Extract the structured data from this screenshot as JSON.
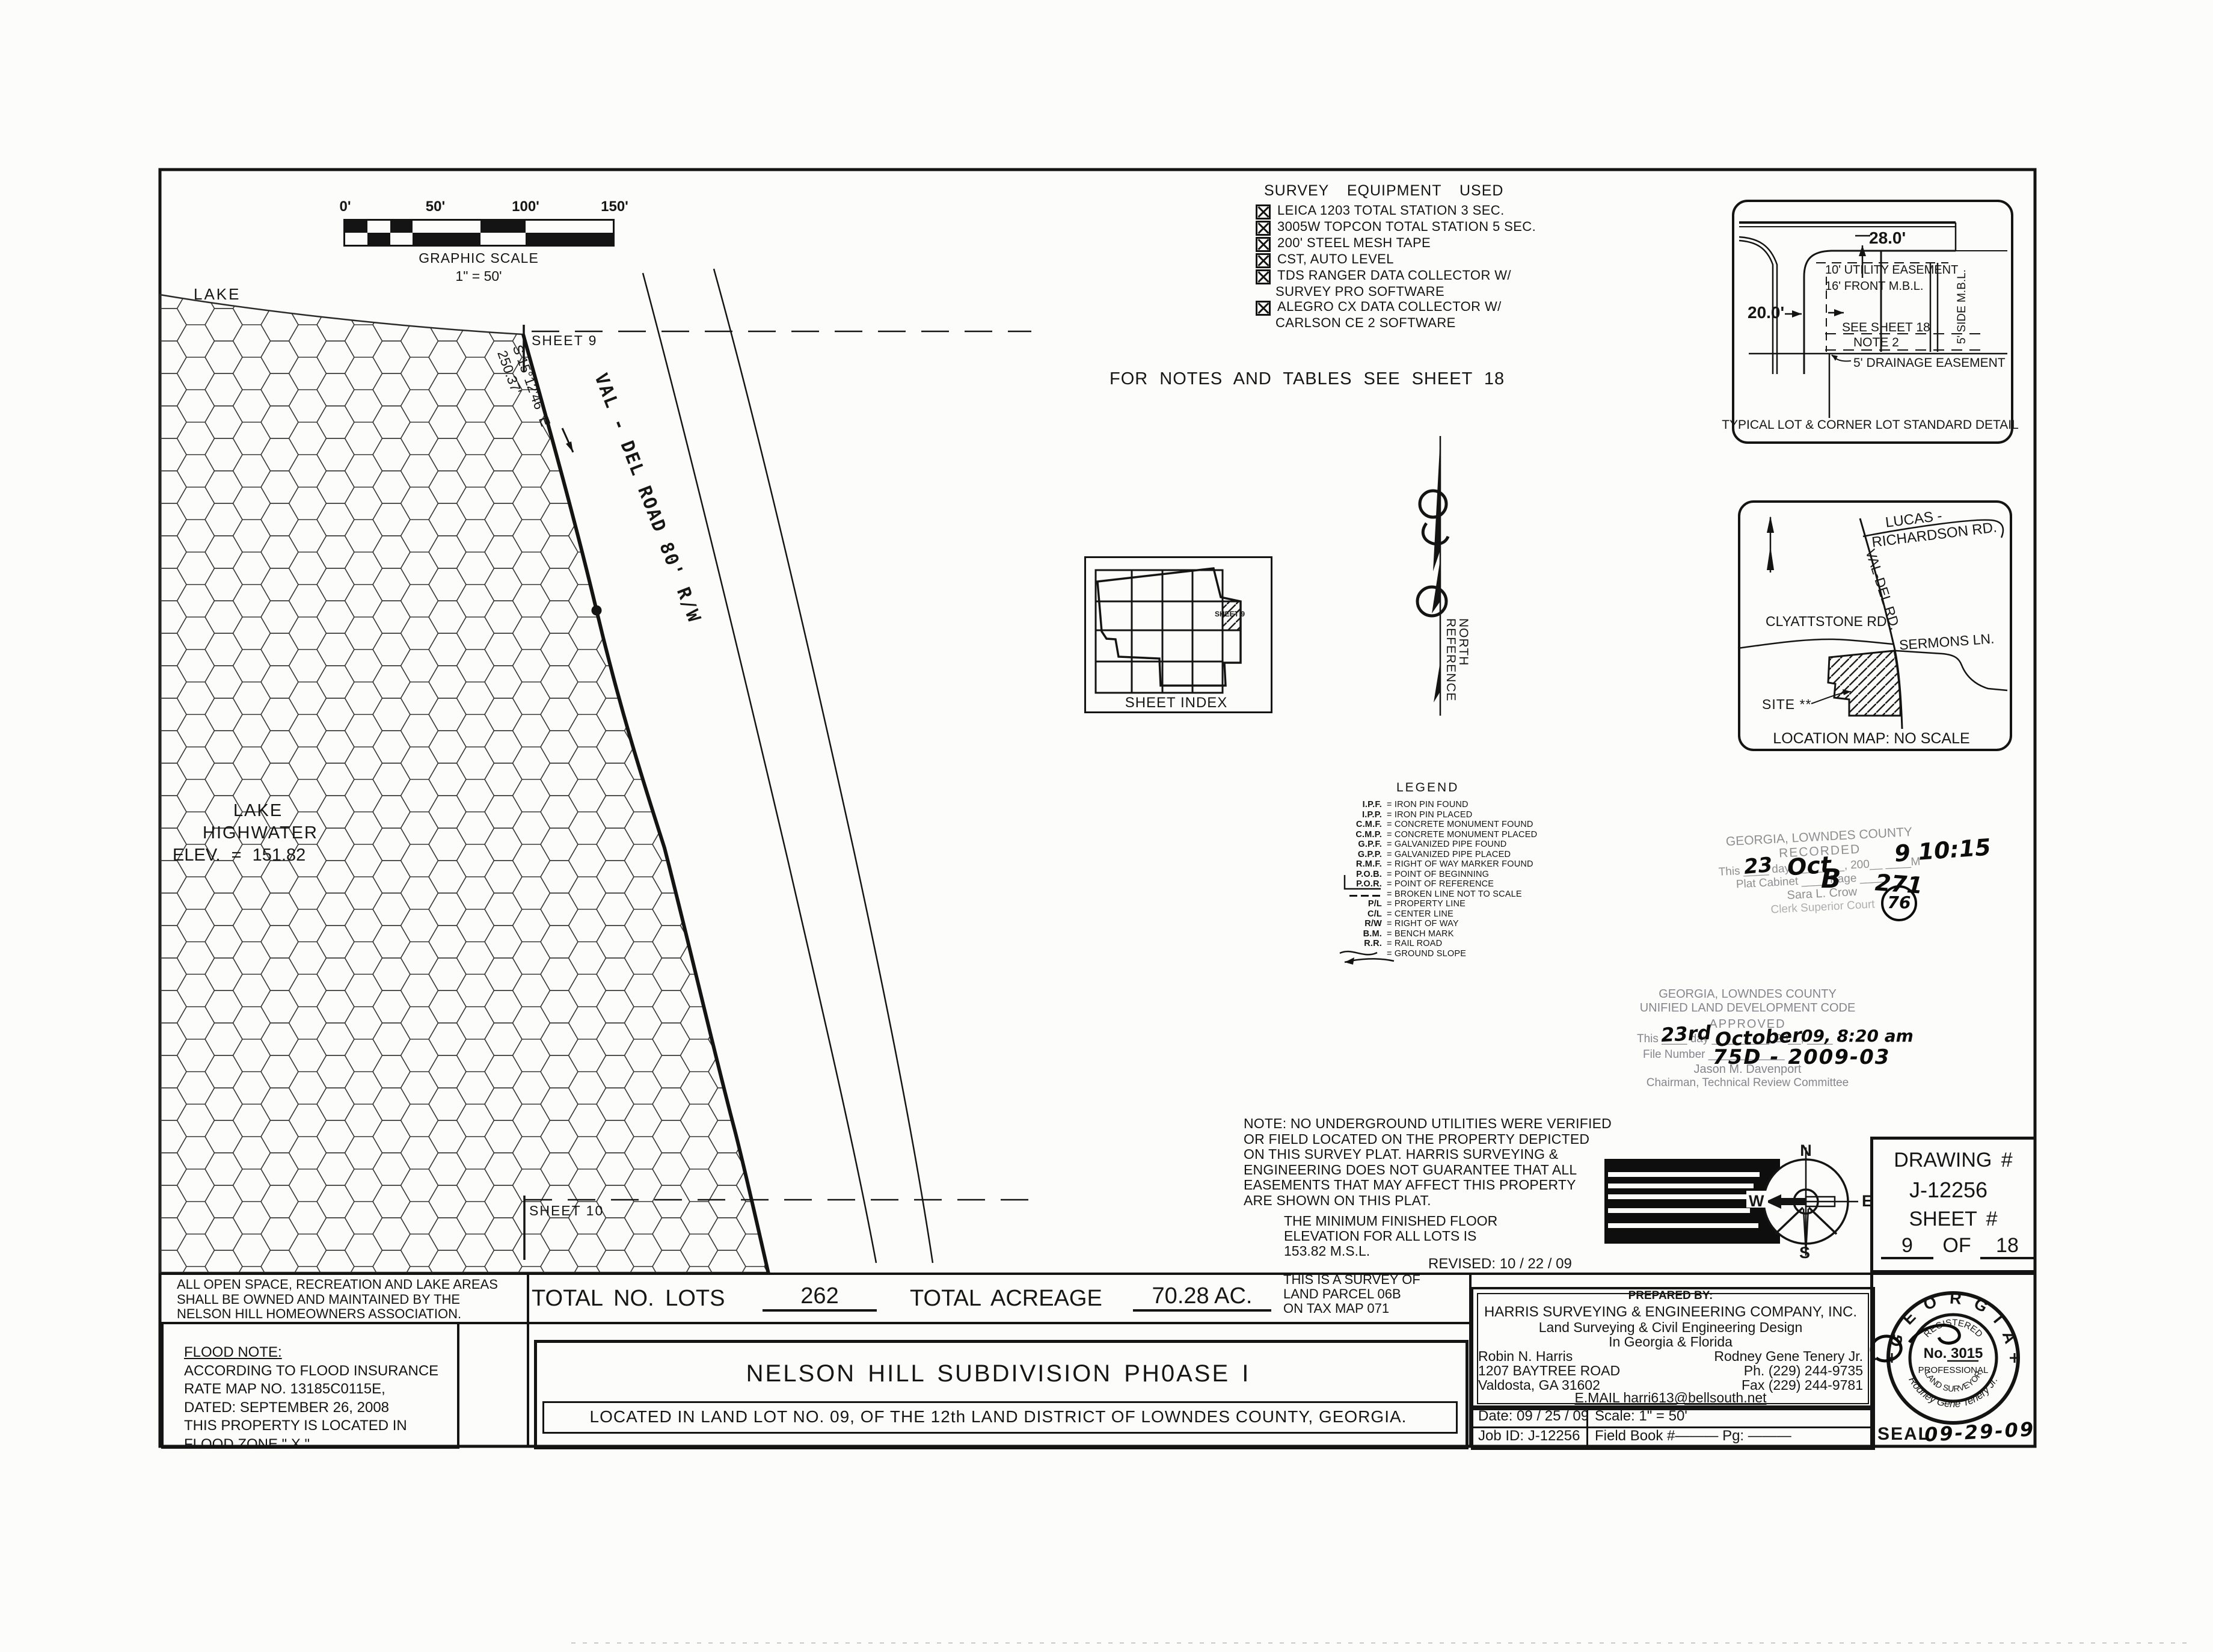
{
  "scalebar": {
    "t0": "0'",
    "t50": "50'",
    "t100": "100'",
    "t150": "150'",
    "caption": "GRAPHIC SCALE",
    "ratio": "1\" = 50'"
  },
  "lake": {
    "name": "LAKE",
    "hw1": "LAKE",
    "hw2": "HIGHWATER",
    "hw3": "ELEV. = 151.82"
  },
  "road": {
    "name": "VAL - DEL ROAD 80' R/W",
    "bearing": "S 15°12'46\" E",
    "distance": "250.37'"
  },
  "match": {
    "top": "SHEET 9",
    "bottom": "SHEET 10"
  },
  "equipment": {
    "title": "SURVEY EQUIPMENT USED",
    "rows": [
      {
        "text": "LEICA 1203 TOTAL STATION 3 SEC."
      },
      {
        "text": "3005W TOPCON TOTAL STATION 5 SEC."
      },
      {
        "text": "200' STEEL MESH TAPE"
      },
      {
        "text": "CST, AUTO LEVEL"
      },
      {
        "text": "TDS RANGER DATA COLLECTOR W/",
        "cont": "SURVEY PRO SOFTWARE"
      },
      {
        "text": "ALEGRO CX DATA COLLECTOR W/",
        "cont": "CARLSON CE 2 SOFTWARE"
      }
    ]
  },
  "banner": "FOR NOTES AND TABLES SEE SHEET 18",
  "sheet_index": {
    "caption": "SHEET INDEX",
    "cell": "SHEET 9"
  },
  "ref_north": {
    "l1": "REFERENCE",
    "l2": "NORTH"
  },
  "legend": {
    "title": "LEGEND",
    "items": [
      {
        "abbr": "I.P.F.",
        "text": "= IRON PIN FOUND"
      },
      {
        "abbr": "I.P.P.",
        "text": "= IRON PIN PLACED"
      },
      {
        "abbr": "C.M.F.",
        "text": "= CONCRETE MONUMENT FOUND"
      },
      {
        "abbr": "C.M.P.",
        "text": "= CONCRETE MONUMENT PLACED"
      },
      {
        "abbr": "G.P.F.",
        "text": "= GALVANIZED PIPE FOUND"
      },
      {
        "abbr": "G.P.P.",
        "text": "= GALVANIZED PIPE PLACED"
      },
      {
        "abbr": "R.M.F.",
        "text": "= RIGHT OF WAY MARKER FOUND"
      },
      {
        "abbr": "P.O.B.",
        "text": "= POINT OF BEGINNING"
      },
      {
        "abbr": "P.O.R.",
        "text": "= POINT OF REFERENCE"
      },
      {
        "abbr": "",
        "sym": "broken-line-icon",
        "text": "= BROKEN LINE NOT TO SCALE"
      },
      {
        "abbr": "P/L",
        "text": "= PROPERTY LINE"
      },
      {
        "abbr": "C/L",
        "text": "= CENTER LINE"
      },
      {
        "abbr": "R/W",
        "text": "= RIGHT OF WAY"
      },
      {
        "abbr": "B.M.",
        "text": "= BENCH MARK"
      },
      {
        "abbr": "R.R.",
        "text": "= RAIL ROAD"
      },
      {
        "abbr": "",
        "sym": "wave-line-icon",
        "text": "= GROUND SLOPE"
      }
    ]
  },
  "detail": {
    "d28": "28.0'",
    "d20": "20.0'",
    "utility": "10' UTILITY EASEMENT",
    "front": "16' FRONT M.B.L.",
    "see1": "SEE SHEET 18",
    "see2": "NOTE 2",
    "side": "5' SIDE M.B.L.",
    "drain": "5' DRAINAGE EASEMENT",
    "caption": "TYPICAL LOT & CORNER LOT STANDARD DETAIL"
  },
  "locmap": {
    "lucas1": "LUCAS -",
    "lucas2": "RICHARDSON RD.",
    "valdel": "VAL-DEL RD.",
    "clyatt": "CLYATTSTONE RD.",
    "sermons": "SERMONS LN.",
    "site": "SITE **",
    "caption": "LOCATION MAP: NO SCALE"
  },
  "recorded": {
    "l1": "GEORGIA, LOWNDES COUNTY",
    "l2": "RECORDED",
    "l3": "This ____ day ________, 200__ ____M",
    "l4": "Plat Cabinet ____ Page ____",
    "l5": "Sara L. Crow",
    "l6": "Clerk Superior Court",
    "hw_day": "23",
    "hw_month": "Oct",
    "hw_cabinet": "B",
    "hw_page": "271",
    "hw_yeartime": "9 10:15",
    "hw_monogram": "76"
  },
  "approved": {
    "l1": "GEORGIA, LOWNDES COUNTY",
    "l2": "UNIFIED LAND DEVELOPMENT CODE",
    "l3": "APPROVED",
    "l4": "This ____ day _________, 20__, ____",
    "l5": "File Number ____________",
    "l6": "Jason M. Davenport",
    "l7": "Chairman, Technical Review Committee",
    "hw_day": "23rd",
    "hw_month": "October",
    "hw_yeartime": "09, 8:20 am",
    "hw_file": "75D - 2009-03"
  },
  "notes": {
    "utility": [
      "NOTE: NO UNDERGROUND UTILITIES WERE VERIFIED",
      "OR FIELD LOCATED ON THE PROPERTY DEPICTED",
      "ON THIS SURVEY PLAT. HARRIS SURVEYING &",
      "ENGINEERING DOES NOT GUARANTEE THAT ALL",
      "EASEMENTS THAT MAY AFFECT THIS PROPERTY",
      "ARE SHOWN ON THIS PLAT."
    ],
    "floor": [
      "THE MINIMUM FINISHED FLOOR",
      "ELEVATION FOR ALL LOTS IS",
      "153.82 M.S.L."
    ],
    "revised": "REVISED: 10 / 22 / 09",
    "survey_of": [
      "THIS IS A SURVEY OF",
      "LAND PARCEL 06B",
      "ON TAX MAP 071"
    ],
    "open_space": [
      "ALL OPEN SPACE, RECREATION AND LAKE AREAS",
      "SHALL BE OWNED AND MAINTAINED BY THE",
      "NELSON HILL HOMEOWNERS ASSOCIATION."
    ],
    "flood": [
      "FLOOD NOTE:",
      "ACCORDING TO FLOOD INSURANCE",
      "RATE MAP NO. 13185C0115E,",
      "DATED: SEPTEMBER 26, 2008",
      "THIS PROPERTY IS LOCATED IN",
      "FLOOD ZONE \" X \"."
    ]
  },
  "totals": {
    "lots_label": "TOTAL NO. LOTS",
    "lots": "262",
    "acre_label": "TOTAL ACREAGE",
    "acre": "70.28 AC."
  },
  "titleblock": {
    "title": "NELSON HILL SUBDIVISION PH0ASE I",
    "subtitle": "LOCATED IN LAND LOT NO. 09, OF THE 12th LAND DISTRICT OF LOWNDES COUNTY, GEORGIA."
  },
  "prepared": {
    "label": "PREPARED BY:",
    "company": "HARRIS SURVEYING & ENGINEERING COMPANY, INC.",
    "l2": "Land Surveying & Civil Engineering Design",
    "l3": "In Georgia & Florida",
    "left1": "Robin N. Harris",
    "left2": "1207 BAYTREE ROAD",
    "left3": "Valdosta, GA 31602",
    "right1": "Rodney Gene Tenery Jr.",
    "right2": "Ph. (229) 244-9735",
    "right3": "Fax (229) 244-9781",
    "email": "E.MAIL  harri613@bellsouth.net"
  },
  "meta": {
    "date": "Date: 09 / 25 / 09",
    "scale": "Scale:  1\" = 50'",
    "job": "Job ID:  J-12256",
    "field": "Field Book #———   Pg: ———",
    "seal_label": "SEAL",
    "seal_date": "09-29-09"
  },
  "drawing": {
    "label": "DRAWING #",
    "number": "J-12256",
    "sheet_label": "SHEET #",
    "sheet_no": "9",
    "of": "OF",
    "total": "18"
  },
  "seal": {
    "state": "G E O R G I A",
    "registered": "REGISTERED",
    "no": "No. 3015",
    "prof": "PROFESSIONAL",
    "surveyor": "LAND SURVEYOR",
    "name": "Rodney Gene Tenery Jr."
  },
  "compass": {
    "n": "N",
    "e": "E",
    "s": "S",
    "w": "W"
  },
  "colors": {
    "ink": "#141414",
    "stamp_gray": "#8f8f92",
    "paper": "#fcfcfb"
  }
}
